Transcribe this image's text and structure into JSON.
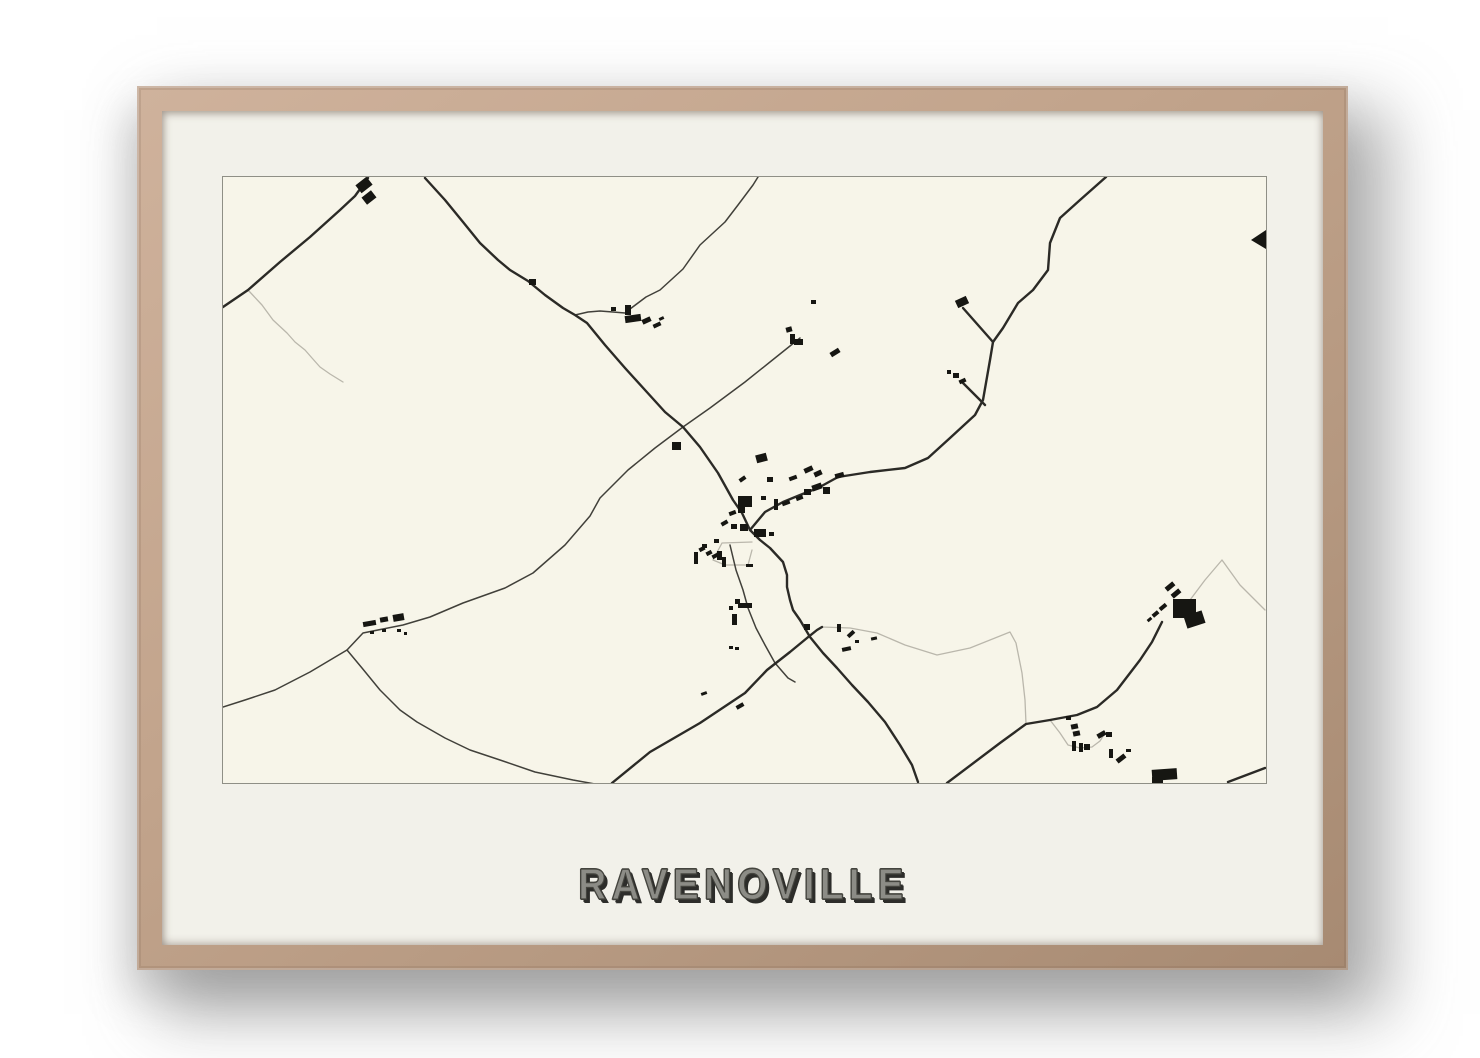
{
  "poster": {
    "title": "RAVENOVILLE",
    "frame_color": "#bfa189",
    "mat_color": "#f2f1ea",
    "paper_color": "#f7f5e9",
    "map_border_color": "#8f8f86",
    "title_color": "#8c8c86",
    "title_shadow_color": "#2d2d2a",
    "road_dark_color": "#2b2a26",
    "road_medium_color": "#41403a",
    "road_light_color": "#bab7ac",
    "building_color": "#161612"
  },
  "map": {
    "viewbox": "0 0 1043 606",
    "roads_dark": [
      "0,130 25,113 57,85 87,60 117,33 132,19 145,1",
      "202,1 222,23 240,45 257,66 275,83 287,93 305,104 322,118 340,131 352,138 364,146 382,168 402,191 422,213 442,235 460,250 477,270 495,296 510,323 519,336 527,353",
      "883,0 857,23 837,41 827,66 825,93 810,113 795,126 780,151 770,165 767,183 760,223 752,238 727,261 705,281 682,291 647,295 615,300 595,311 577,318 560,325 542,335 527,353",
      "527,353 537,363 547,371 560,385 564,398 564,410 567,423 570,433 577,443 587,460 600,476 614,491 629,508 645,525 662,545 677,568 689,588 695,605",
      "389,606 427,575 477,546 522,516 544,493 567,475 584,461 594,453 599,450",
      "724,606 777,566 803,547 827,543 854,538 874,530 894,513 917,483 929,465 939,445",
      "1005,605 1042,591",
      "770,165 755,148 740,131",
      "762,228 747,213 739,205"
    ],
    "roads_medium": [
      "577,161 547,185 522,205 487,231 460,250 432,271 405,293 377,321 367,339 342,368 310,396 282,411 240,426 207,440 180,448 140,456 124,473 87,495 52,513 22,523 0,530",
      "124,473 139,491 157,513 177,533 194,545 222,561 247,573 277,583 312,595 350,603 372,607",
      "403,135 423,120 437,113 460,92 477,68 502,45 515,28 530,8 535,0",
      "352,138 365,135 377,134 390,135 402,136",
      "507,368 513,393 520,413 525,431 533,451 542,468 552,486 565,501 572,505"
    ],
    "roads_light": [
      "25,113 39,128 50,143 64,156 72,165 82,173 89,181 97,190 107,197 120,205",
      "599,450 627,451 654,456 682,468 714,478 747,471 787,455 793,466 799,496 802,523 803,547",
      "967,423 982,403 999,383 1017,408 1042,433",
      "827,543 837,556 845,568 857,571 869,570 877,564 882,556",
      "529,365 499,366 490,383 502,388 525,388 529,373"
    ],
    "polygons": [
      "1043,53 1043,72 1028,63"
    ],
    "buildings": [
      [
        134,
        3,
        14,
        10,
        -38
      ],
      [
        140,
        16,
        12,
        9,
        -38
      ],
      [
        306,
        102,
        7,
        6,
        0
      ],
      [
        402,
        128,
        6,
        10,
        0
      ],
      [
        402,
        138,
        16,
        7,
        -8
      ],
      [
        388,
        130,
        5,
        4,
        0
      ],
      [
        419,
        141,
        9,
        5,
        -25
      ],
      [
        430,
        146,
        8,
        4,
        -25
      ],
      [
        436,
        140,
        5,
        3,
        -25
      ],
      [
        563,
        150,
        6,
        5,
        -15
      ],
      [
        567,
        157,
        5,
        10,
        0
      ],
      [
        571,
        162,
        9,
        6,
        0
      ],
      [
        588,
        123,
        5,
        4,
        0
      ],
      [
        607,
        173,
        10,
        5,
        -32
      ],
      [
        733,
        121,
        12,
        8,
        -25
      ],
      [
        730,
        196,
        6,
        5,
        0
      ],
      [
        736,
        202,
        7,
        4,
        -25
      ],
      [
        724,
        193,
        4,
        4,
        0
      ],
      [
        449,
        265,
        9,
        8,
        0
      ],
      [
        533,
        277,
        11,
        8,
        -15
      ],
      [
        581,
        290,
        9,
        5,
        -25
      ],
      [
        591,
        294,
        8,
        5,
        -25
      ],
      [
        566,
        299,
        8,
        4,
        -20
      ],
      [
        544,
        300,
        6,
        5,
        0
      ],
      [
        516,
        300,
        7,
        4,
        -35
      ],
      [
        589,
        307,
        10,
        6,
        -20
      ],
      [
        600,
        310,
        7,
        7,
        0
      ],
      [
        581,
        312,
        7,
        6,
        0
      ],
      [
        573,
        319,
        7,
        4,
        -20
      ],
      [
        559,
        324,
        8,
        4,
        -20
      ],
      [
        551,
        322,
        4,
        11,
        0
      ],
      [
        538,
        319,
        5,
        4,
        0
      ],
      [
        515,
        319,
        14,
        11,
        0
      ],
      [
        515,
        330,
        7,
        6,
        0
      ],
      [
        506,
        334,
        7,
        4,
        -20
      ],
      [
        498,
        344,
        7,
        4,
        -30
      ],
      [
        508,
        347,
        6,
        5,
        0
      ],
      [
        517,
        347,
        8,
        7,
        0
      ],
      [
        531,
        352,
        12,
        8,
        0
      ],
      [
        546,
        355,
        5,
        4,
        0
      ],
      [
        612,
        296,
        9,
        5,
        -15
      ],
      [
        491,
        362,
        5,
        4,
        0
      ],
      [
        479,
        367,
        5,
        4,
        0
      ],
      [
        476,
        370,
        6,
        4,
        -28
      ],
      [
        483,
        374,
        6,
        4,
        -28
      ],
      [
        489,
        377,
        6,
        4,
        -28
      ],
      [
        471,
        375,
        4,
        12,
        0
      ],
      [
        494,
        374,
        5,
        9,
        0
      ],
      [
        499,
        380,
        4,
        10,
        0
      ],
      [
        523,
        387,
        7,
        3,
        0
      ],
      [
        506,
        429,
        4,
        4,
        0
      ],
      [
        509,
        437,
        5,
        11,
        0
      ],
      [
        515,
        426,
        14,
        5,
        0
      ],
      [
        512,
        422,
        5,
        5,
        0
      ],
      [
        506,
        469,
        4,
        3,
        0
      ],
      [
        512,
        470,
        4,
        3,
        0
      ],
      [
        478,
        515,
        6,
        3,
        -20
      ],
      [
        513,
        527,
        8,
        4,
        -30
      ],
      [
        581,
        447,
        6,
        6,
        0
      ],
      [
        614,
        447,
        4,
        8,
        0
      ],
      [
        624,
        455,
        8,
        4,
        -42
      ],
      [
        619,
        470,
        9,
        4,
        -12
      ],
      [
        632,
        463,
        4,
        3,
        0
      ],
      [
        648,
        460,
        6,
        3,
        -12
      ],
      [
        140,
        444,
        13,
        5,
        -10
      ],
      [
        157,
        440,
        8,
        5,
        -10
      ],
      [
        170,
        437,
        11,
        7,
        -10
      ],
      [
        147,
        454,
        4,
        3,
        0
      ],
      [
        159,
        452,
        4,
        3,
        0
      ],
      [
        174,
        452,
        4,
        3,
        0
      ],
      [
        181,
        455,
        3,
        3,
        0
      ],
      [
        843,
        539,
        5,
        4,
        0
      ],
      [
        848,
        547,
        7,
        5,
        -12
      ],
      [
        850,
        554,
        7,
        5,
        -12
      ],
      [
        849,
        564,
        4,
        10,
        0
      ],
      [
        856,
        566,
        4,
        9,
        0
      ],
      [
        861,
        567,
        6,
        6,
        0
      ],
      [
        874,
        555,
        9,
        5,
        -30
      ],
      [
        883,
        555,
        6,
        5,
        0
      ],
      [
        886,
        572,
        4,
        9,
        0
      ],
      [
        893,
        579,
        10,
        5,
        -38
      ],
      [
        903,
        572,
        5,
        3,
        0
      ],
      [
        929,
        592,
        25,
        11,
        -4
      ],
      [
        929,
        600,
        11,
        6,
        0
      ],
      [
        950,
        422,
        23,
        19,
        0
      ],
      [
        962,
        436,
        19,
        13,
        -18
      ],
      [
        942,
        407,
        10,
        5,
        -40
      ],
      [
        948,
        414,
        10,
        5,
        -40
      ],
      [
        936,
        428,
        8,
        4,
        -40
      ],
      [
        929,
        435,
        7,
        4,
        -40
      ],
      [
        924,
        441,
        5,
        3,
        -40
      ]
    ]
  }
}
